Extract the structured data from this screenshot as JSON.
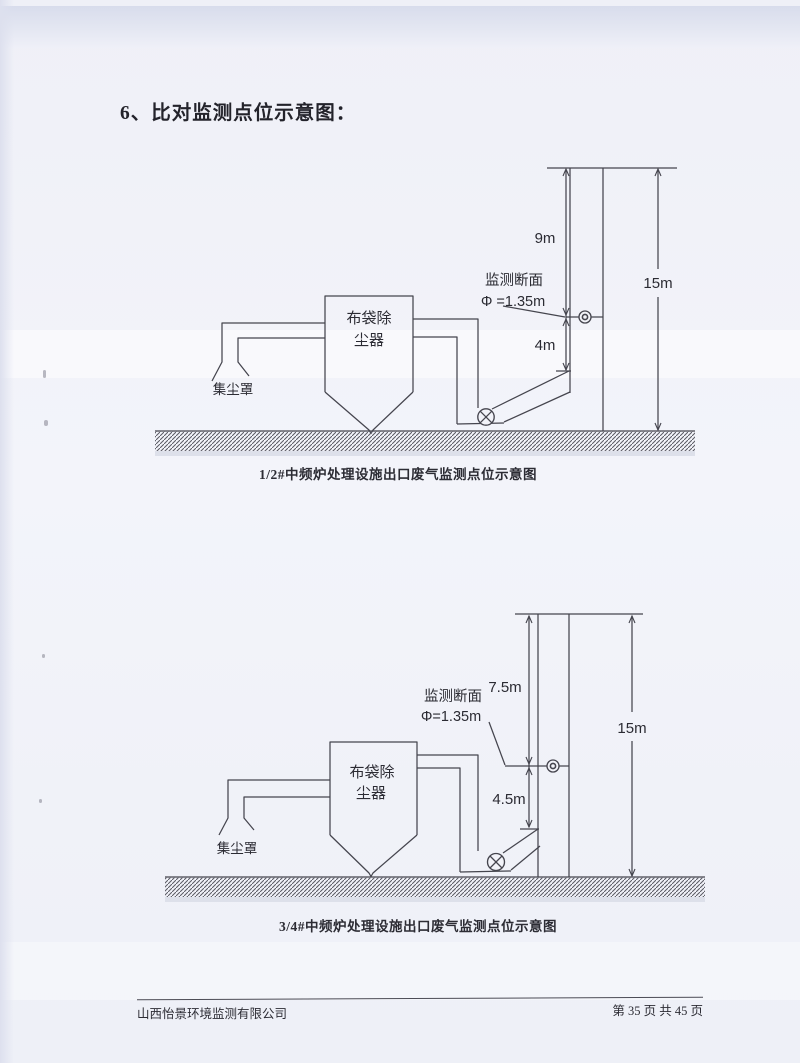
{
  "page": {
    "heading": "6、比对监测点位示意图：",
    "footer": {
      "company": "山西怡景环境监测有限公司",
      "page_info": "第 35 页 共 45 页"
    }
  },
  "colors": {
    "paper": "#f2f3f9",
    "ink": "#45454e",
    "text": "#2b2b33",
    "top_band": "#d8dcec"
  },
  "diagrams": [
    {
      "caption": "1/2#中频炉处理设施出口废气监测点位示意图",
      "equipment": {
        "hood": "集尘罩",
        "filter_line1": "布袋除",
        "filter_line2": "尘器"
      },
      "monitoring": {
        "section": "监测断面",
        "diameter": "Φ =1.35m"
      },
      "dimensions": {
        "above_port": "9m",
        "below_port": "4m",
        "total_height": "15m"
      }
    },
    {
      "caption": "3/4#中频炉处理设施出口废气监测点位示意图",
      "equipment": {
        "hood": "集尘罩",
        "filter_line1": "布袋除",
        "filter_line2": "尘器"
      },
      "monitoring": {
        "section": "监测断面",
        "diameter": "Φ=1.35m"
      },
      "dimensions": {
        "above_port": "7.5m",
        "below_port": "4.5m",
        "total_height": "15m"
      }
    }
  ]
}
